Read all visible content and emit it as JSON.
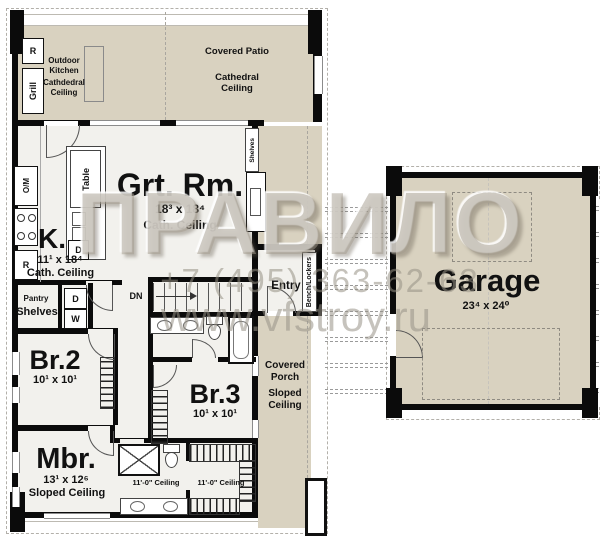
{
  "watermark": {
    "brand": "ПРАВИЛО",
    "phone": "+7 (495) 363-62-63",
    "website": "www.vfstroy.ru"
  },
  "rooms": {
    "outdoor_kitchen": {
      "name": "Outdoor Kitchen",
      "ceiling": "Cathdedral Ceiling"
    },
    "covered_patio": {
      "name": "Covered Patio",
      "ceiling": "Cathedral Ceiling"
    },
    "great_room": {
      "name": "Grt. Rm.",
      "dims": "18³ x 18⁴",
      "ceiling": "Cath. Ceiling"
    },
    "kitchen": {
      "name": "K.",
      "dims": "11¹ x 18⁴",
      "ceiling": "Cath. Ceiling"
    },
    "pantry": {
      "name": "Pantry",
      "shelves_label": "Shelves"
    },
    "entry": {
      "name": "Entry"
    },
    "stairs": {
      "label": "DN"
    },
    "bedroom2": {
      "name": "Br.2",
      "dims": "10¹ x 10¹"
    },
    "bedroom3": {
      "name": "Br.3",
      "dims": "10¹ x 10¹"
    },
    "master_bedroom": {
      "name": "Mbr.",
      "dims": "13¹ x 12⁶",
      "ceiling": "Sloped Ceiling"
    },
    "master_bath": {
      "ceiling": "11'-0\" Ceiling"
    },
    "master_closet": {
      "ceiling": "11'-0\" Ceiling"
    },
    "covered_porch": {
      "name": "Covered Porch",
      "ceiling": "Sloped Ceiling"
    },
    "garage": {
      "name": "Garage",
      "dims": "23⁴ x 24⁰"
    }
  },
  "fixtures": {
    "outdoor_fridge": "R",
    "grill": "Grill",
    "oven_microwave": "O/M",
    "range_fridge": "R",
    "dishwasher": "D",
    "island_table": "Table",
    "dryer": "D",
    "washer": "W",
    "great_room_shelves": "Shelves",
    "bench_lockers": "Bench/Lockers"
  },
  "colors": {
    "covered_area": "#d9d2c0",
    "interior": "#f2f1ed",
    "wall": "#0b0b0b",
    "watermark_gray": "#a49c8c"
  }
}
